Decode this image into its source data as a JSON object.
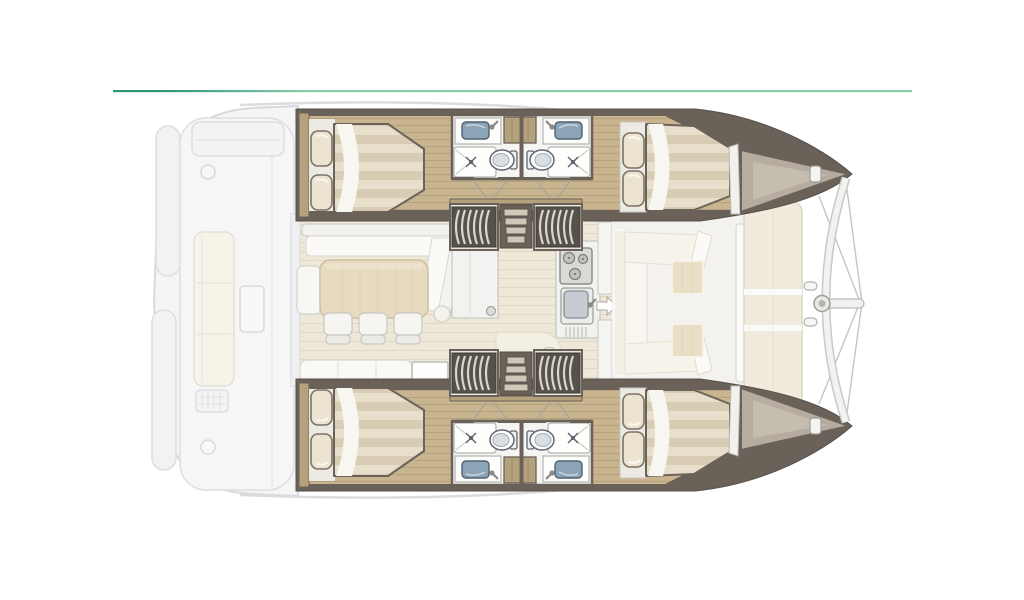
{
  "plan": {
    "vessel_type": "catamaran-yacht-deck-floor-plan",
    "orientation": "bow-right-stern-left",
    "hulls": 2,
    "cabins": 4,
    "bathrooms": 4,
    "areas": [
      {
        "name": "aft-cockpit",
        "style": "ghosted",
        "items": [
          "aft-bench",
          "side-sofa",
          "deck-table",
          "deck-grate",
          "deck-hatch-circle",
          "transom-platforms"
        ]
      },
      {
        "name": "saloon",
        "items": [
          "l-shaped-sofa",
          "dining-table",
          "dining-chairs",
          "sideboard-cabinet",
          "aft-bench-sofa",
          "chart-table",
          "curved-nook-bench",
          "round-table"
        ]
      },
      {
        "name": "galley",
        "items": [
          "stove-three-burners",
          "sink-with-faucet",
          "drainer"
        ]
      },
      {
        "name": "forward-cockpit",
        "items": [
          "u-shaped-sofa",
          "cocktail-table",
          "cocktail-table",
          "entry-door-arrow"
        ]
      },
      {
        "name": "foredeck",
        "items": [
          "sunpads",
          "forward-crossbeam",
          "bowsprit",
          "rigging-stays",
          "cleats"
        ]
      },
      {
        "name": "starboard-hull",
        "items": [
          "aft-double-bed",
          "two-pillows",
          "bathroom-pair",
          "toilet",
          "toilet",
          "shower",
          "shower",
          "washbasin",
          "washbasin",
          "companionway-stairs",
          "forward-double-bed",
          "bow-locker",
          "bow-cleat"
        ]
      },
      {
        "name": "port-hull",
        "items": [
          "aft-double-bed",
          "two-pillows",
          "bathroom-pair",
          "toilet",
          "toilet",
          "shower",
          "shower",
          "washbasin",
          "washbasin",
          "companionway-stairs",
          "forward-double-bed",
          "bow-locker",
          "bow-cleat"
        ]
      }
    ],
    "counts": {
      "dining_chairs": 3,
      "toilets": 4,
      "showers": 4,
      "washbasins": 4,
      "double_beds": 4,
      "stair_units_per_hull": 3,
      "sunpad_sections": 3
    }
  },
  "colors": {
    "accent_left": "#31957a",
    "accent_right": "#8bd0aa",
    "hull_wall": "#6a6158",
    "wood": "#c8b58f",
    "wood_line": "#a8946e",
    "wood_trim": "#b5a17b",
    "saloon_floor": "#eee8d8",
    "saloon_floor_line": "#ded5c1",
    "deck_floor": "#f3f2ef",
    "pad": "#f0ebdc",
    "cream": "#f3efe2",
    "beige_table": "#e6dabf",
    "mattress_a": "#e7dfcc",
    "mattress_b": "#d8cdb4",
    "pillow": "#ece4d1",
    "bath_floor": "#f4f4f3",
    "basin": "#8ba4b7",
    "fixture_stroke": "#5f666d",
    "stair_dark": "#56514b",
    "stair_stripe": "#d9d6d0",
    "step_tread": "#cfc8b8",
    "locker": "#b6aca0",
    "locker_light": "#c9c0b4",
    "ghost_fill": "#f5f5f6",
    "ghost_stroke": "#d9d9dc",
    "shell_line": "#dcdcdf"
  }
}
